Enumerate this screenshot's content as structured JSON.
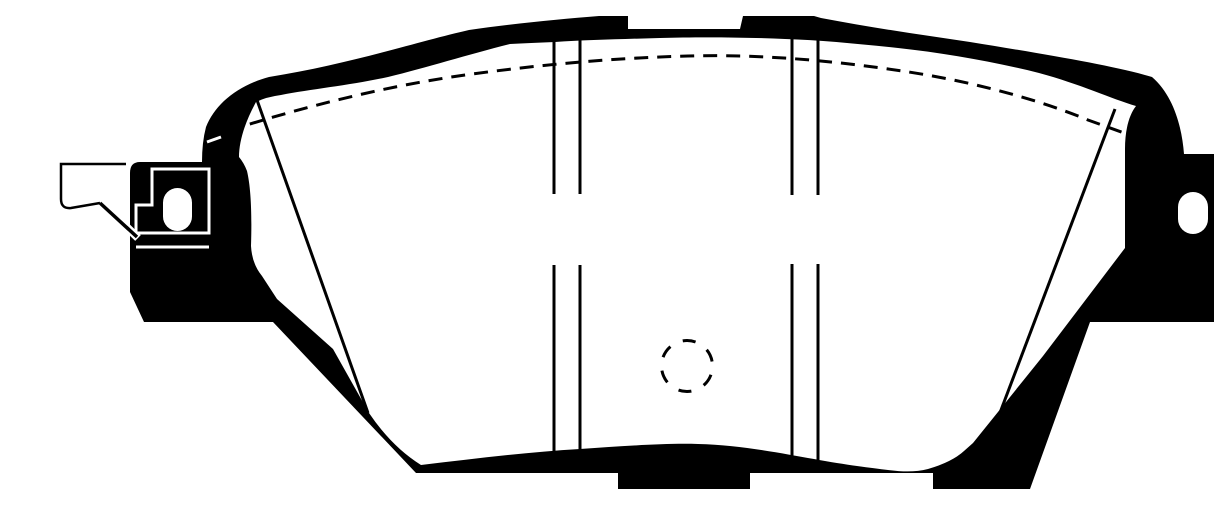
{
  "figure": {
    "description": "Black and white technical line drawing of a disc brake pad, shown from the friction-surface side with backing-plate ears and mounting holes on both ends",
    "type": "technical-line-drawing"
  },
  "colors": {
    "ink": "#000000",
    "background": "#ffffff"
  },
  "parts": {
    "silhouette": "backing-plate-and-friction-outline",
    "left_lug": "left-abutment-lug-with-shim-outline",
    "left_hole": "left-lug-hole",
    "right_hole": "right-lug-hole",
    "clip": "wear-indicator-clip-outline",
    "dashed_top": "dashed-chamfer-arc",
    "dashed_circle": "dashed-center-hole",
    "slots_left": "left-slot-line-pair",
    "slots_right": "right-slot-line-pair",
    "chamfer_left": "left-chamfer-edge-line",
    "chamfer_right": "right-chamfer-edge-line"
  }
}
